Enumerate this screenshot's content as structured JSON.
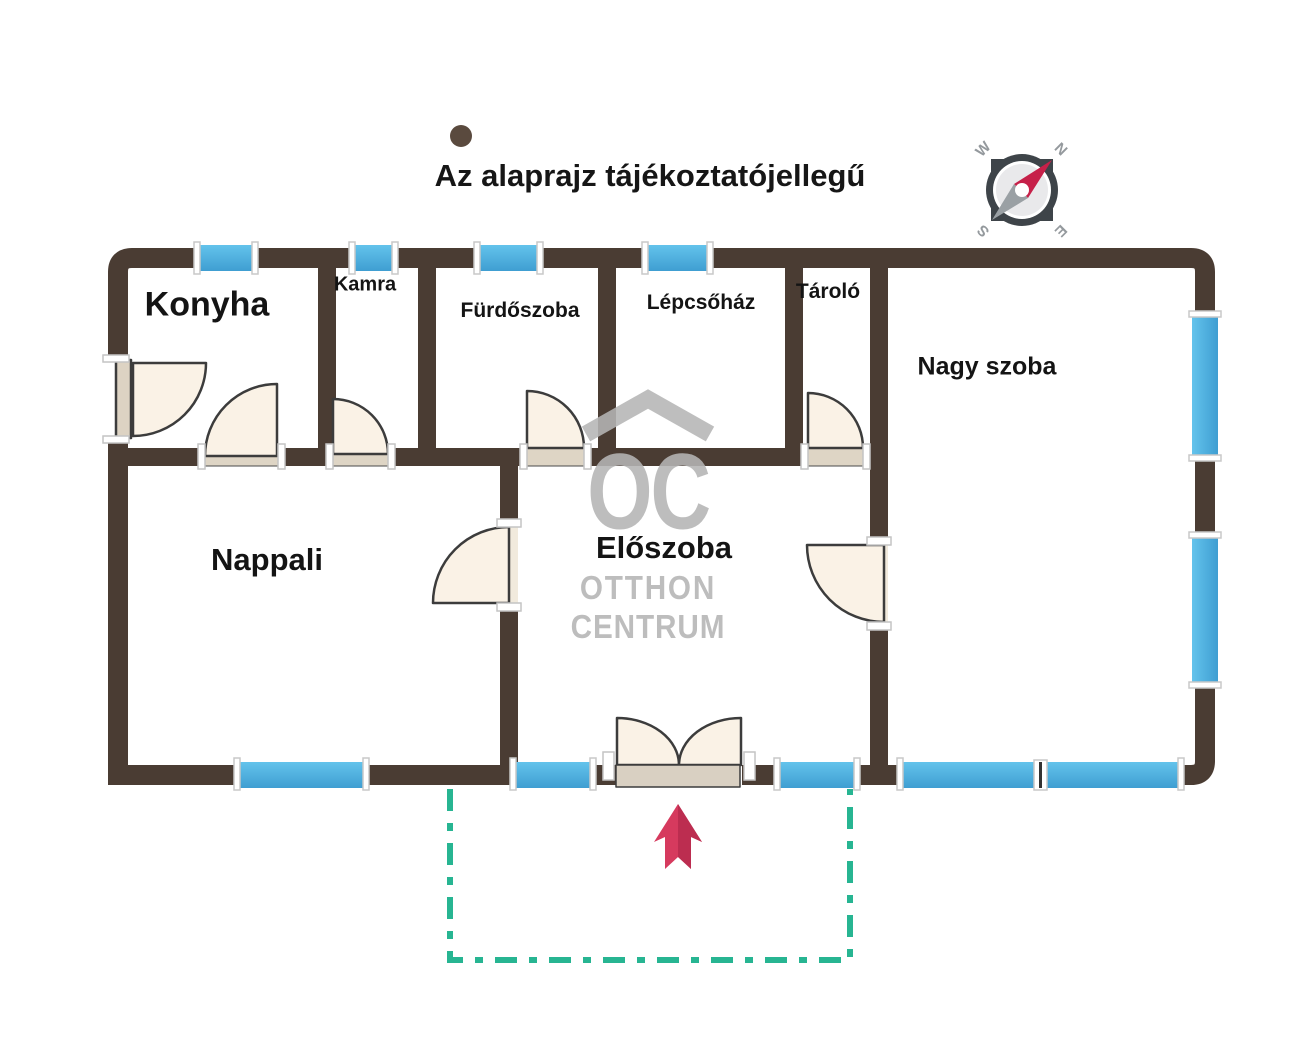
{
  "title": "Az alaprajz tájékoztatójellegű",
  "rooms": {
    "konyha": "Konyha",
    "kamra": "Kamra",
    "furdoszoba": "Fürdőszoba",
    "lepcsohaz": "Lépcsőház",
    "tarolo": "Tároló",
    "nagy_szoba": "Nagy szoba",
    "nappali": "Nappali",
    "eloszoba": "Előszoba"
  },
  "watermark": {
    "logo": "OC",
    "line1": "OTTHON",
    "line2": "CENTRUM"
  },
  "compass": {
    "north": "N",
    "east": "E",
    "south": "S",
    "west": "W"
  },
  "colors": {
    "wall": "#4a3c33",
    "window_light": "#63c3ec",
    "window_dark": "#3f9ed2",
    "door_fill": "#faf2e6",
    "door_panel": "#ddd3c3",
    "threshold": "#ded5c5",
    "plot_boundary_teal": "#27b592",
    "arrow_red": "#d63a5e",
    "watermark_gray": "#b5b5b5",
    "compass_needle_red": "#c62049"
  }
}
